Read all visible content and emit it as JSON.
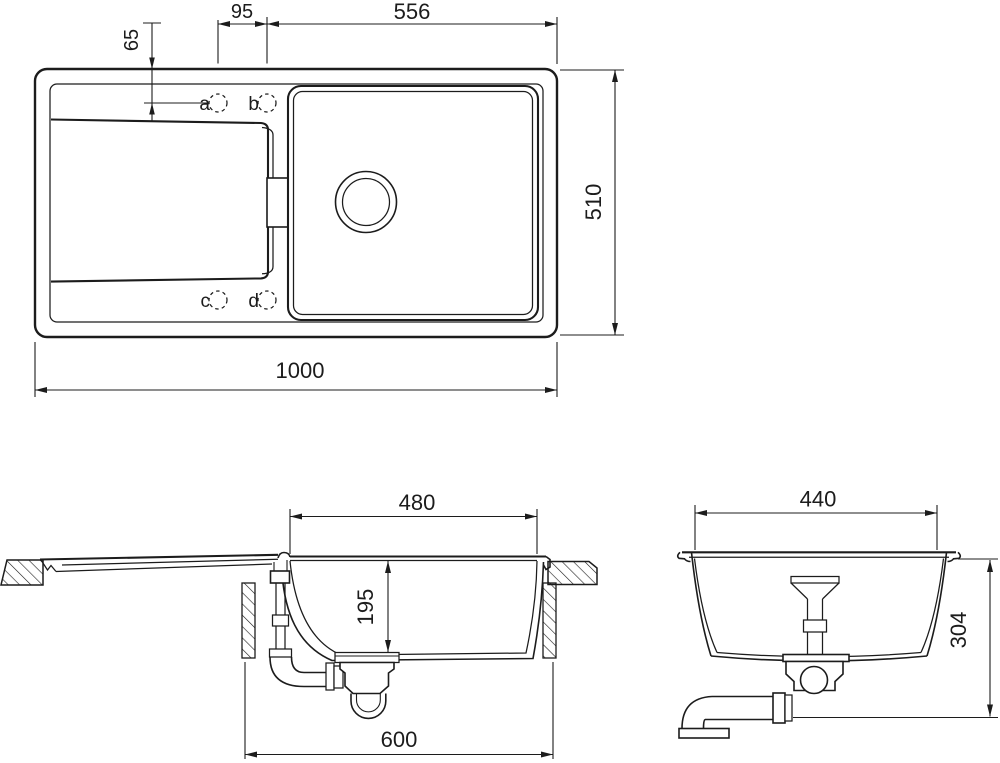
{
  "drawing": {
    "type": "technical-dimension-drawing",
    "subject": "kitchen sink with drainboard and single bowl",
    "background": "#ffffff",
    "line_color": "#1c1c1c",
    "plan": {
      "view_name": "plan-view",
      "dims": {
        "hole_spacing": {
          "label": "95"
        },
        "bowl_span": {
          "label": "556"
        },
        "hole_offset": {
          "label": "65"
        },
        "overall_depth": {
          "label": "510"
        },
        "overall_width": {
          "label": "1000"
        }
      },
      "tap_holes": [
        {
          "label": "a"
        },
        {
          "label": "b"
        },
        {
          "label": "c"
        },
        {
          "label": "d"
        }
      ]
    },
    "side": {
      "view_name": "side-section-view",
      "dims": {
        "bowl_length": {
          "label": "480"
        },
        "bowl_depth": {
          "label": "195"
        },
        "cabinet_width": {
          "label": "600"
        }
      }
    },
    "end": {
      "view_name": "end-section-view",
      "dims": {
        "bowl_width": {
          "label": "440"
        },
        "overall_height": {
          "label": "304"
        }
      }
    }
  }
}
